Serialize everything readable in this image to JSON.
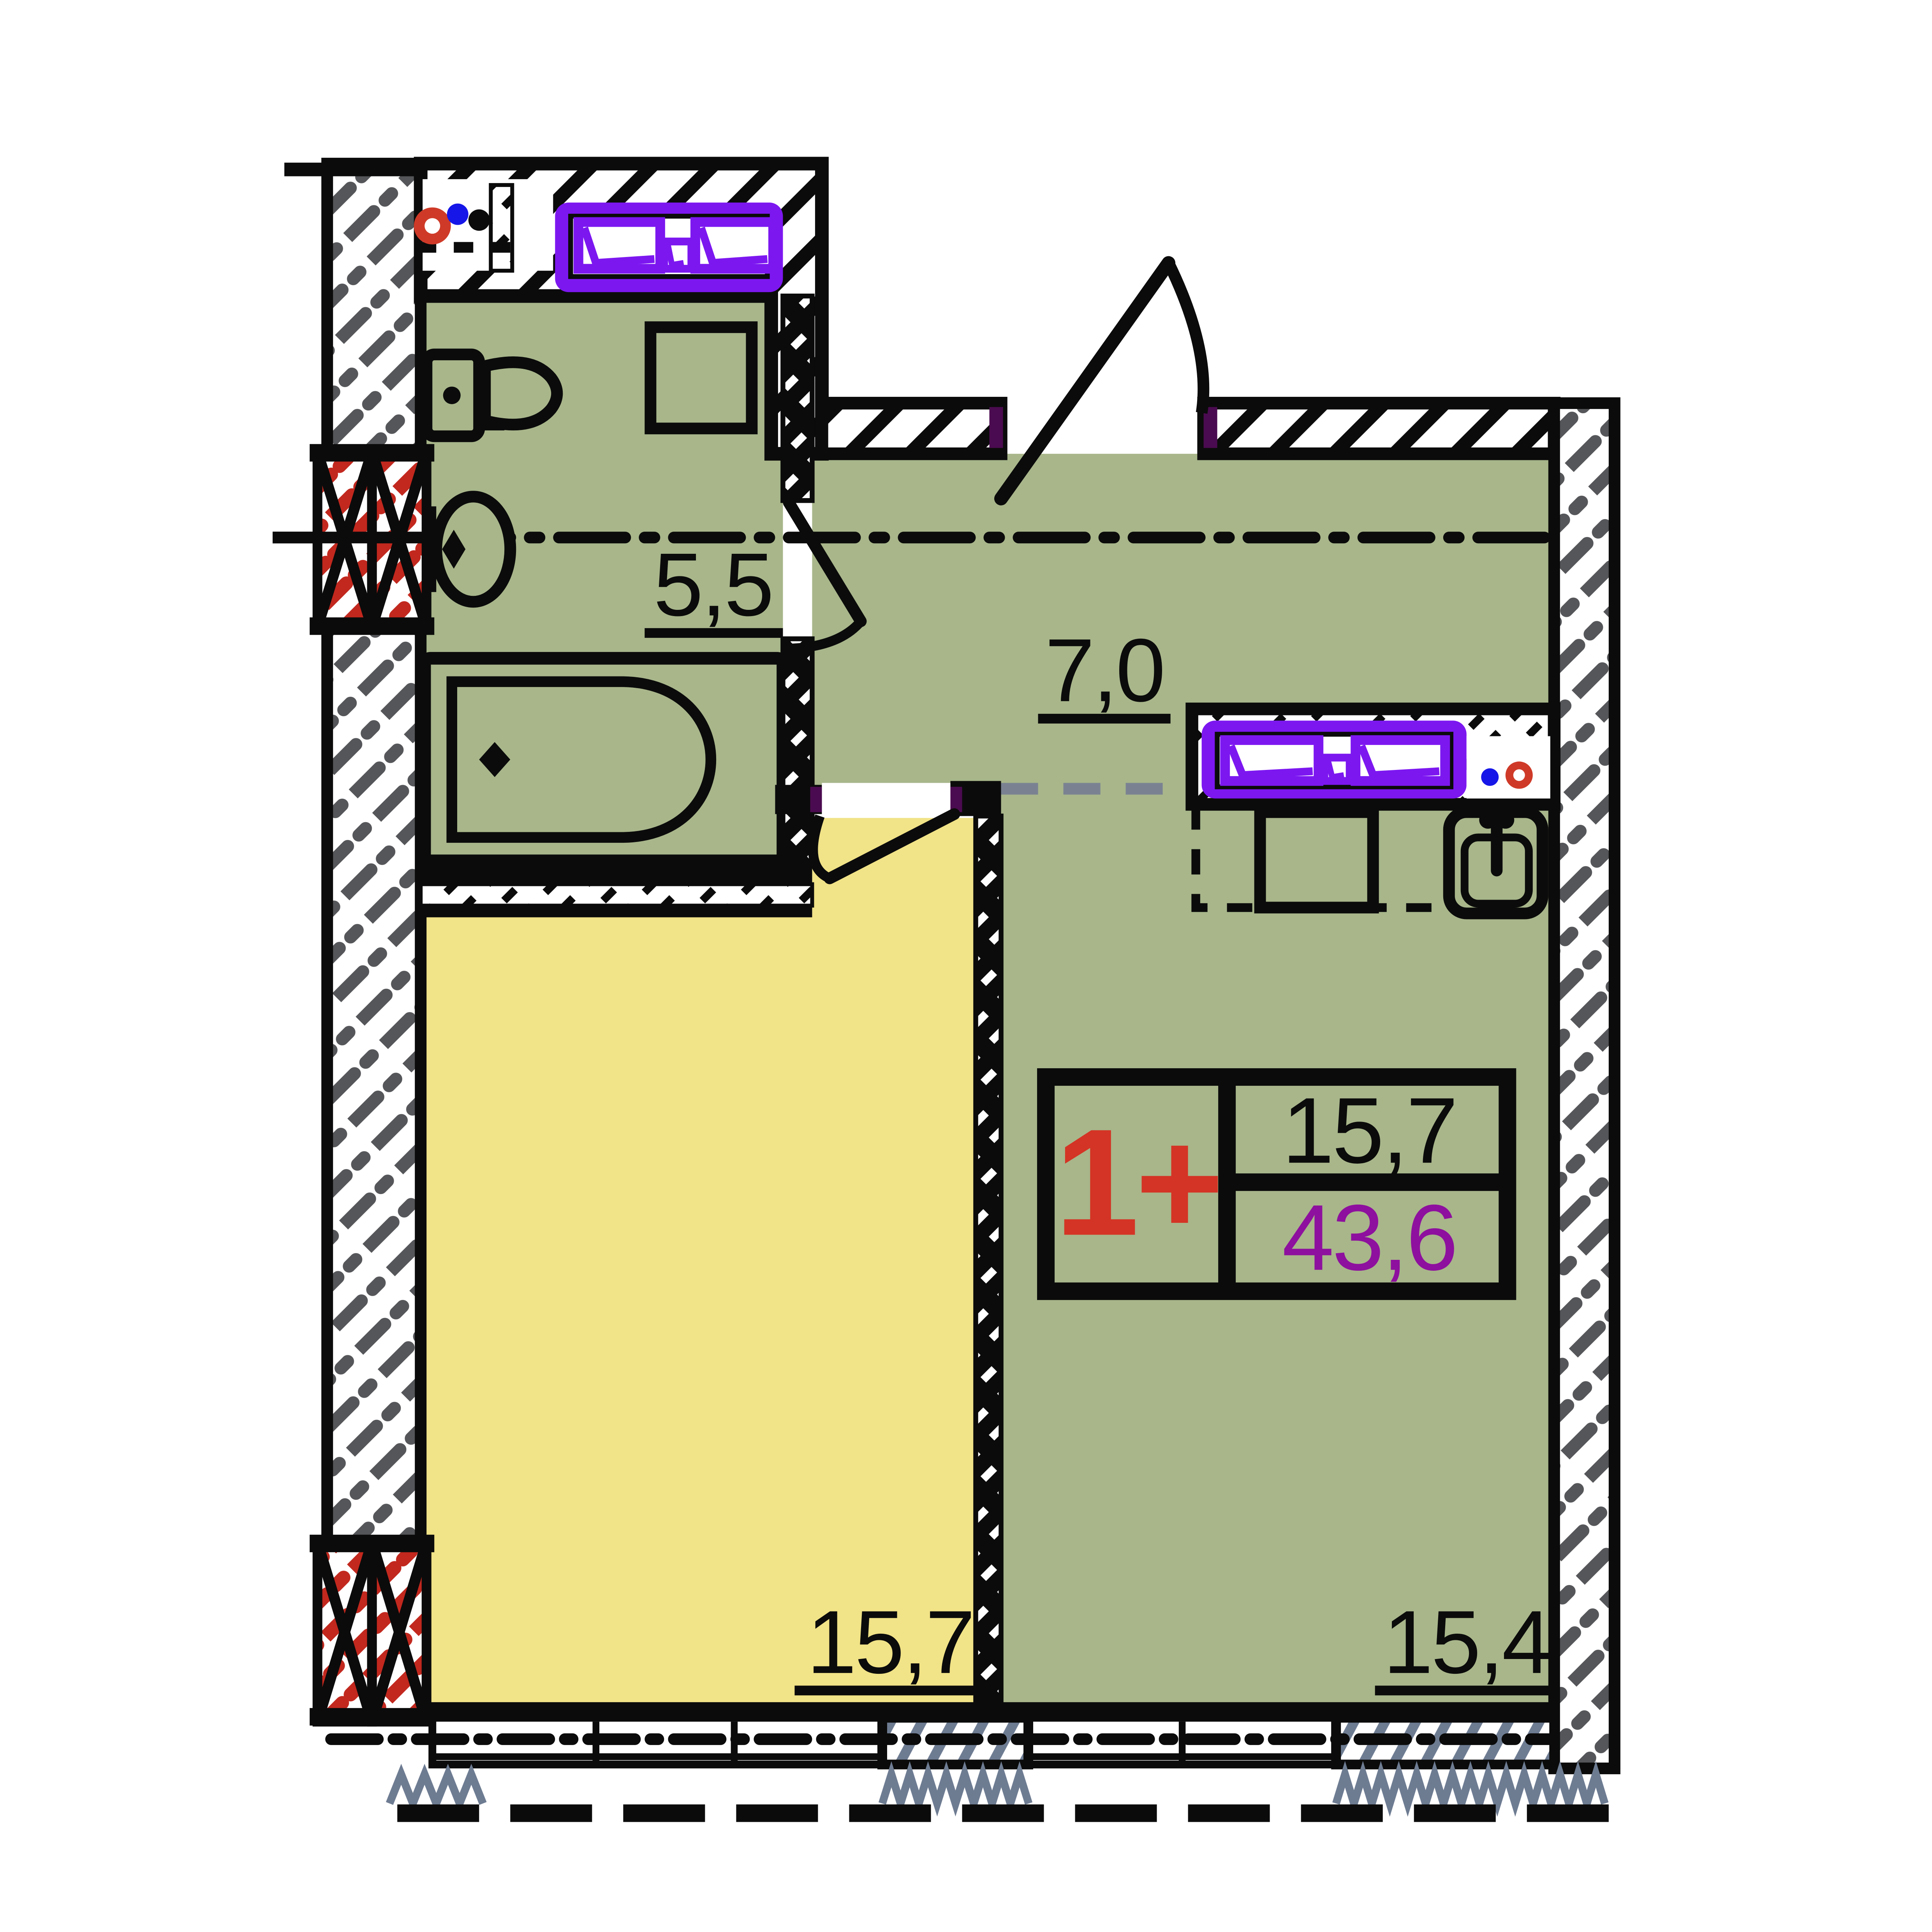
{
  "plan": {
    "kind": "apartment-floor-plan",
    "rooms": [
      {
        "id": "bathroom",
        "area": "5,5"
      },
      {
        "id": "hall",
        "area": "7,0"
      },
      {
        "id": "bedroom",
        "area": "15,7"
      },
      {
        "id": "living-kitchen",
        "area": "15,4"
      }
    ],
    "info_box": {
      "apartment_type": "1+",
      "living_area": "15,7",
      "total_area": "43,6"
    },
    "colors": {
      "room_green": "#a8b68a",
      "room_yellow": "#f1e387",
      "window_purple": "#7c17f0",
      "type_red": "#d43425",
      "total_area_purple": "#8e109e",
      "vent_hatch_red": "#c2281e",
      "wall_hatch_gray": "#555659",
      "slate_detail": "#6e7c92",
      "cold_water_blue": "#1616e8",
      "hot_water_red": "#cf3a28",
      "door_jamb_purple": "#4b0b50",
      "zone_dash_gray": "#7a8292"
    }
  }
}
